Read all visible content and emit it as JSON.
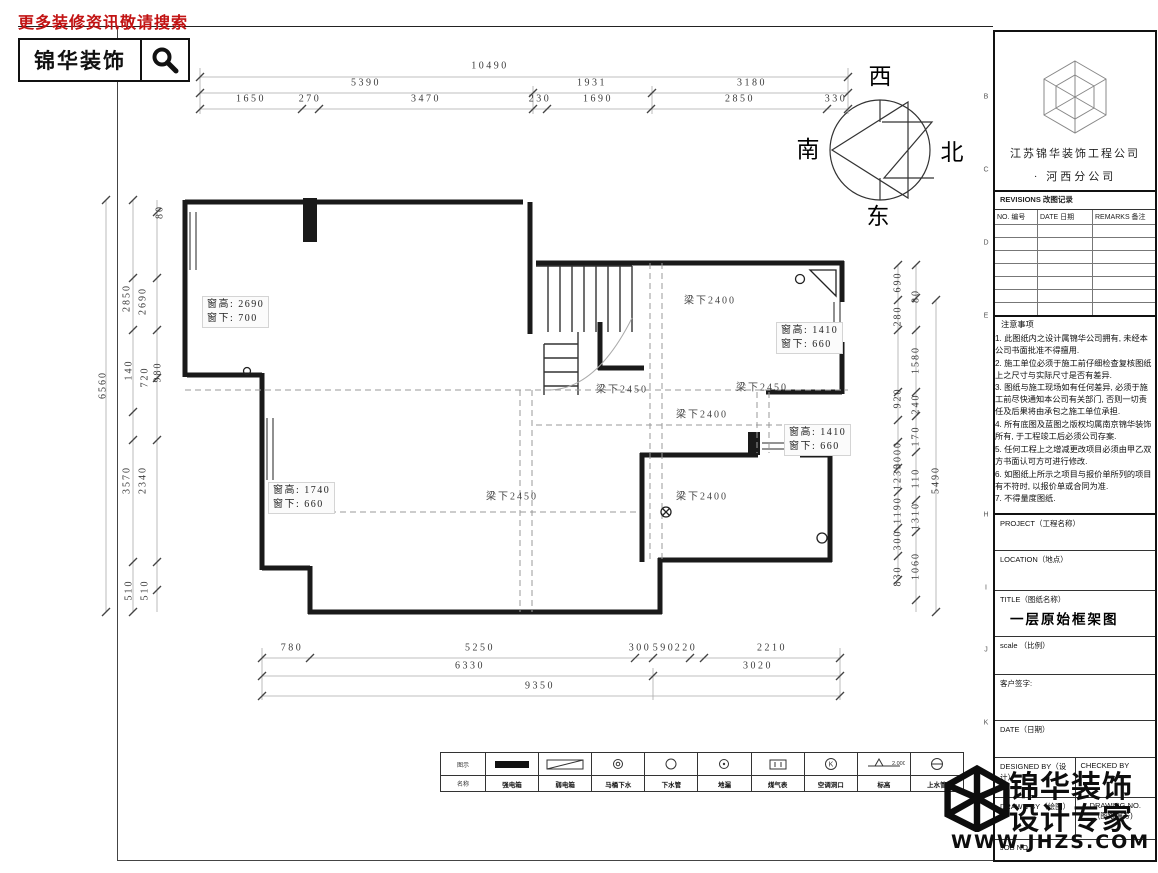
{
  "ad": {
    "tagline": "更多装修资讯敬请搜索",
    "brand": "锦华装饰"
  },
  "compass": {
    "top": "西",
    "left": "南",
    "right": "北",
    "bottom": "东"
  },
  "watermark": {
    "line1": "锦华装饰",
    "line2": "设计专家",
    "url": "WWW.JHZS.COM"
  },
  "title_block": {
    "company_line1": "江苏锦华装饰工程公司",
    "company_line2": "·   河西分公司",
    "revisions_title": "REVISIONS 改图记录",
    "revisions_cols": [
      "NO. 编号",
      "DATE 日期",
      "REMARKS 备注"
    ],
    "revisions_empty_rows": 7,
    "notes_title": "注意事项",
    "notes": [
      "1. 此图纸内之设计属锦华公司拥有, 未经本公司书面批准不得擅用.",
      "2. 施工单位必须于施工前仔细检查复核图纸上之尺寸与实际尺寸是否有差异.",
      "3. 图纸与施工现场如有任何差异, 必须于施工前尽快通知本公司有关部门, 否则一切责任及后果将由承包之施工单位承担.",
      "4. 所有底图及蓝图之版权均属南京锦华装饰所有, 于工程竣工后必须公司存案.",
      "5. 任何工程上之增减更改项目必须由甲乙双方书面认可方可进行修改.",
      "6. 如图纸上所示之项目与报价单所列的项目有不符时, 以报价单或合同为准.",
      "7. 不得量度图纸."
    ],
    "project_label": "PROJECT（工程名称）",
    "location_label": "LOCATION（地点）",
    "title_label": "TITLE（图纸名称）",
    "title_value": "一层原始框架图",
    "scale_label": "scale （比例）",
    "client_sign_label": "客户签字:",
    "date_label": "DATE（日期）",
    "designed_label": "DESIGNED BY（设计）",
    "checked_label": "CHECKED BY",
    "drawn_label": "DRAWN BY（绘图）",
    "drawing_no_label1": "DRAWING NO.",
    "drawing_no_label2": "(图纸编号)",
    "job_label": "JOB NO."
  },
  "legend": {
    "col_label_top": "图示",
    "col_label_bottom": "名称",
    "items": [
      {
        "symbol": "solid-rect",
        "name": "强电箱"
      },
      {
        "symbol": "diag-rect",
        "name": "弱电箱"
      },
      {
        "symbol": "circle-double",
        "name": "马桶下水"
      },
      {
        "symbol": "circle",
        "name": "下水管"
      },
      {
        "symbol": "circle-dot",
        "name": "地漏"
      },
      {
        "symbol": "meter-box",
        "name": "煤气表"
      },
      {
        "symbol": "circle-k",
        "name": "空调洞口"
      },
      {
        "symbol": "level-mark",
        "name": "标高",
        "value": "2.000"
      },
      {
        "symbol": "circle-dash",
        "name": "上水管"
      }
    ]
  },
  "window_labels": [
    {
      "l1": "窗高: 2690",
      "l2": "窗下: 700",
      "x": 202,
      "y": 296
    },
    {
      "l1": "窗高: 1410",
      "l2": "窗下: 660",
      "x": 776,
      "y": 322
    },
    {
      "l1": "窗高: 1410",
      "l2": "窗下: 660",
      "x": 784,
      "y": 424
    },
    {
      "l1": "窗高: 1740",
      "l2": "窗下: 660",
      "x": 268,
      "y": 482
    }
  ],
  "annotations": [
    {
      "t": "10490",
      "x": 490,
      "y": 66,
      "cls": "dim"
    },
    {
      "t": "5390",
      "x": 366,
      "y": 83,
      "cls": "dim"
    },
    {
      "t": "1931",
      "x": 592,
      "y": 83,
      "cls": "dim"
    },
    {
      "t": "3180",
      "x": 752,
      "y": 83,
      "cls": "dim"
    },
    {
      "t": "1650",
      "x": 251,
      "y": 99,
      "cls": "dim"
    },
    {
      "t": "270",
      "x": 310,
      "y": 99,
      "cls": "dim"
    },
    {
      "t": "3470",
      "x": 426,
      "y": 99,
      "cls": "dim"
    },
    {
      "t": "230",
      "x": 540,
      "y": 99,
      "cls": "dim"
    },
    {
      "t": "1690",
      "x": 598,
      "y": 99,
      "cls": "dim"
    },
    {
      "t": "2850",
      "x": 740,
      "y": 99,
      "cls": "dim"
    },
    {
      "t": "330",
      "x": 836,
      "y": 99,
      "cls": "dim"
    },
    {
      "t": "780",
      "x": 292,
      "y": 648,
      "cls": "dim"
    },
    {
      "t": "5250",
      "x": 480,
      "y": 648,
      "cls": "dim"
    },
    {
      "t": "300",
      "x": 640,
      "y": 648,
      "cls": "dim"
    },
    {
      "t": "590",
      "x": 664,
      "y": 648,
      "cls": "dim"
    },
    {
      "t": "220",
      "x": 686,
      "y": 648,
      "cls": "dim"
    },
    {
      "t": "2210",
      "x": 772,
      "y": 648,
      "cls": "dim"
    },
    {
      "t": "6330",
      "x": 470,
      "y": 666,
      "cls": "dim"
    },
    {
      "t": "3020",
      "x": 758,
      "y": 666,
      "cls": "dim"
    },
    {
      "t": "9350",
      "x": 540,
      "y": 686,
      "cls": "dim"
    },
    {
      "t": "6560",
      "x": 103,
      "y": 385,
      "cls": "dimv"
    },
    {
      "t": "2850",
      "x": 127,
      "y": 298,
      "cls": "dimv"
    },
    {
      "t": "2690",
      "x": 143,
      "y": 301,
      "cls": "dimv"
    },
    {
      "t": "80",
      "x": 160,
      "y": 212,
      "cls": "dimv"
    },
    {
      "t": "140",
      "x": 129,
      "y": 370,
      "cls": "dimv"
    },
    {
      "t": "720",
      "x": 145,
      "y": 377,
      "cls": "dimv"
    },
    {
      "t": "980",
      "x": 158,
      "y": 372,
      "cls": "dimv"
    },
    {
      "t": "3570",
      "x": 127,
      "y": 480,
      "cls": "dimv"
    },
    {
      "t": "2340",
      "x": 143,
      "y": 480,
      "cls": "dimv"
    },
    {
      "t": "510",
      "x": 129,
      "y": 590,
      "cls": "dimv"
    },
    {
      "t": "510",
      "x": 145,
      "y": 590,
      "cls": "dimv"
    },
    {
      "t": "690",
      "x": 898,
      "y": 282,
      "cls": "dimv"
    },
    {
      "t": "280",
      "x": 898,
      "y": 316,
      "cls": "dimv"
    },
    {
      "t": "920",
      "x": 898,
      "y": 398,
      "cls": "dimv"
    },
    {
      "t": "3000",
      "x": 898,
      "y": 455,
      "cls": "dimv"
    },
    {
      "t": "1230",
      "x": 898,
      "y": 476,
      "cls": "dimv"
    },
    {
      "t": "1190",
      "x": 898,
      "y": 510,
      "cls": "dimv"
    },
    {
      "t": "300",
      "x": 898,
      "y": 540,
      "cls": "dimv"
    },
    {
      "t": "830",
      "x": 898,
      "y": 576,
      "cls": "dimv"
    },
    {
      "t": "80",
      "x": 916,
      "y": 296,
      "cls": "dimv"
    },
    {
      "t": "1580",
      "x": 916,
      "y": 360,
      "cls": "dimv"
    },
    {
      "t": "240",
      "x": 916,
      "y": 404,
      "cls": "dimv"
    },
    {
      "t": "170",
      "x": 916,
      "y": 436,
      "cls": "dimv"
    },
    {
      "t": "110",
      "x": 916,
      "y": 478,
      "cls": "dimv"
    },
    {
      "t": "1310",
      "x": 916,
      "y": 516,
      "cls": "dimv"
    },
    {
      "t": "1060",
      "x": 916,
      "y": 566,
      "cls": "dimv"
    },
    {
      "t": "5490",
      "x": 936,
      "y": 480,
      "cls": "dimv"
    },
    {
      "t": "梁下2400",
      "x": 710,
      "y": 299,
      "cls": "beam"
    },
    {
      "t": "梁下2450",
      "x": 622,
      "y": 388,
      "cls": "beam"
    },
    {
      "t": "梁下2450",
      "x": 762,
      "y": 386,
      "cls": "beam"
    },
    {
      "t": "梁下2400",
      "x": 702,
      "y": 413,
      "cls": "beam"
    },
    {
      "t": "梁下2450",
      "x": 512,
      "y": 495,
      "cls": "beam"
    },
    {
      "t": "梁下2400",
      "x": 702,
      "y": 495,
      "cls": "beam"
    },
    {
      "t": "西",
      "x": 880,
      "y": 74,
      "cls": "compass-ch"
    },
    {
      "t": "南",
      "x": 808,
      "y": 147,
      "cls": "compass-ch"
    },
    {
      "t": "北",
      "x": 952,
      "y": 150,
      "cls": "compass-ch"
    },
    {
      "t": "东",
      "x": 878,
      "y": 214,
      "cls": "compass-ch"
    },
    {
      "t": "B",
      "x": 986,
      "y": 97,
      "cls": "rowletter"
    },
    {
      "t": "C",
      "x": 986,
      "y": 170,
      "cls": "rowletter"
    },
    {
      "t": "D",
      "x": 986,
      "y": 243,
      "cls": "rowletter"
    },
    {
      "t": "E",
      "x": 986,
      "y": 316,
      "cls": "rowletter"
    },
    {
      "t": "H",
      "x": 986,
      "y": 515,
      "cls": "rowletter"
    },
    {
      "t": "I",
      "x": 986,
      "y": 588,
      "cls": "rowletter"
    },
    {
      "t": "J",
      "x": 986,
      "y": 650,
      "cls": "rowletter"
    },
    {
      "t": "K",
      "x": 986,
      "y": 723,
      "cls": "rowletter"
    }
  ]
}
